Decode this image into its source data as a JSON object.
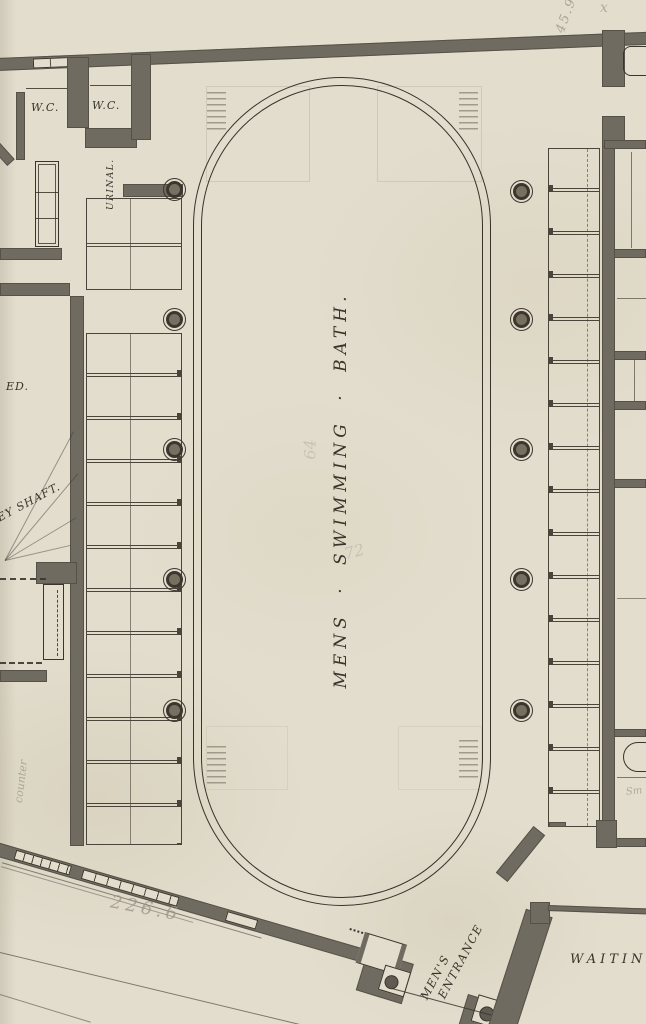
{
  "labels": {
    "wc_left": "W.C.",
    "wc_right": "W.C.",
    "urinal": "URINAL.",
    "ed": "ED.",
    "shaft": "EY SHAFT.",
    "pool": "MENS · SWIMMING · BATH.",
    "mens_entrance_line1": "MEN'S",
    "mens_entrance_line2": "ENTRANCE",
    "waiting": "WAITING"
  },
  "pencil": {
    "dim_bottom": "226.6",
    "dim_top_right": "45.9",
    "x_mark": "x",
    "counter": "counter",
    "small_room": "Sm",
    "faint_1": "64",
    "faint_2": "72"
  },
  "colors": {
    "paper": "#e2ddcd",
    "wall": "#6f6b60",
    "ink": "#3a352c",
    "pencil": "#9d968a"
  }
}
